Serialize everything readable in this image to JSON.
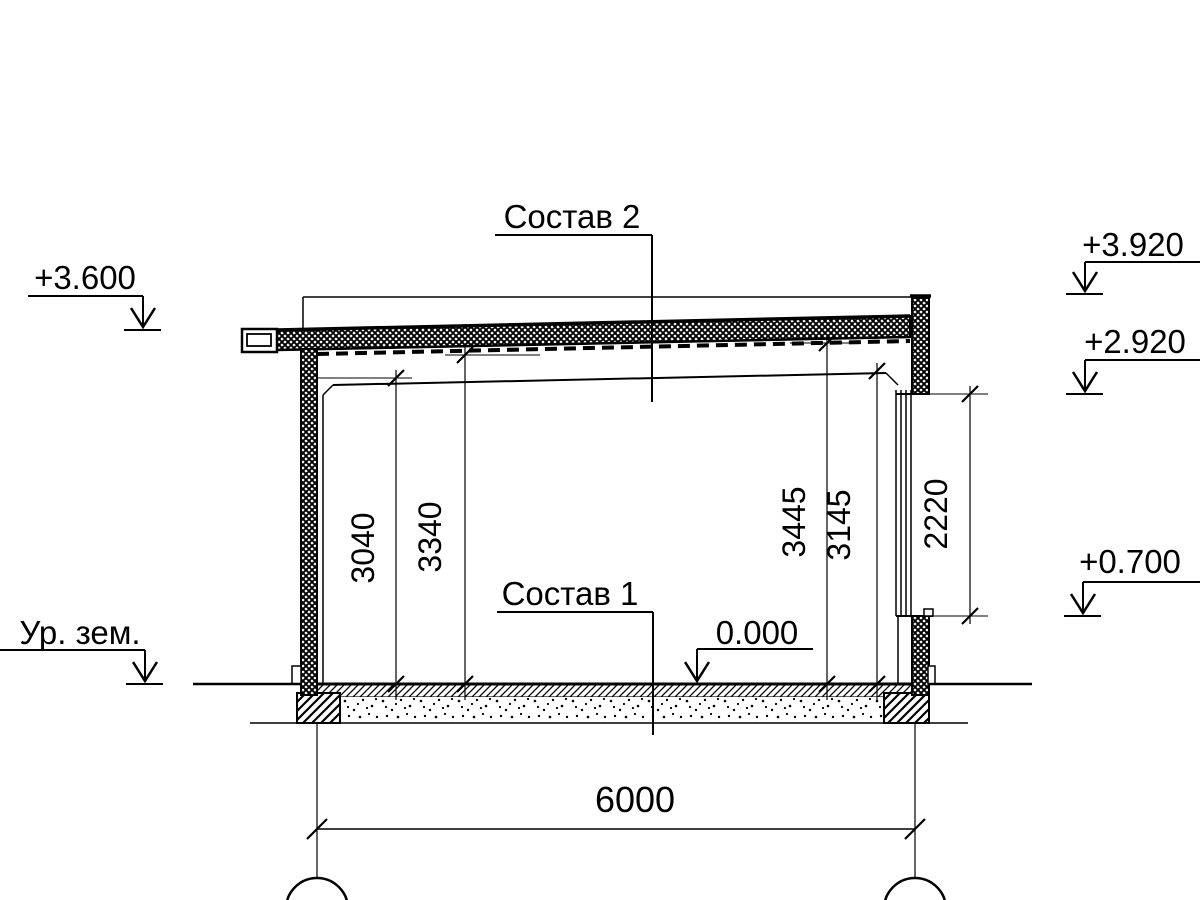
{
  "labels": {
    "roof_composition": "Состав 2",
    "floor_composition": "Состав 1"
  },
  "elevation_marks": {
    "eave_top": "+3.600",
    "ground_level": "Ур. зем.",
    "parapet_top": "+3.920",
    "window_head": "+2.920",
    "window_sill": "+0.700",
    "floor_level": "0.000"
  },
  "dimensions": {
    "ceiling_height_left": "3040",
    "slab_soffit_left": "3340",
    "slab_soffit_right": "3445",
    "ceiling_height_right": "3145",
    "window_opening": "2220",
    "span": "6000"
  },
  "colors": {
    "line": "#000000",
    "background": "#ffffff"
  }
}
